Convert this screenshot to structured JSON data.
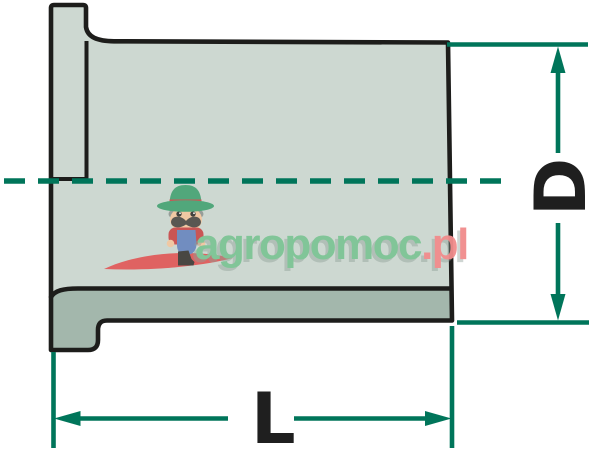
{
  "dimensions": {
    "diameter": {
      "label": "D"
    },
    "length": {
      "label": "L"
    }
  },
  "watermark": {
    "brand": "agropomoc",
    "tld": ".pl"
  },
  "colors": {
    "outline": "#1d1d1b",
    "body-fill": "#cdd8d1",
    "section-fill": "#a3b7ac",
    "dimension": "#00755a",
    "label": "#1f1f1f",
    "brand-green": "#7dc595",
    "brand-pink": "#f18c8c",
    "shadow-gray": "#8d9d95",
    "swoosh-red": "#e05c5c",
    "hat-green": "#4ba577",
    "hat-band-red": "#cc4f4f",
    "skin": "#f2c8a1",
    "hair-gray": "#95  9b97",
    "mustache-gray": "#53514c",
    "shirt-red": "#c94f4f",
    "overalls-blue": "#6d89c0",
    "boot-dark": "#42403c",
    "eye-dark": "#3a3b38"
  }
}
